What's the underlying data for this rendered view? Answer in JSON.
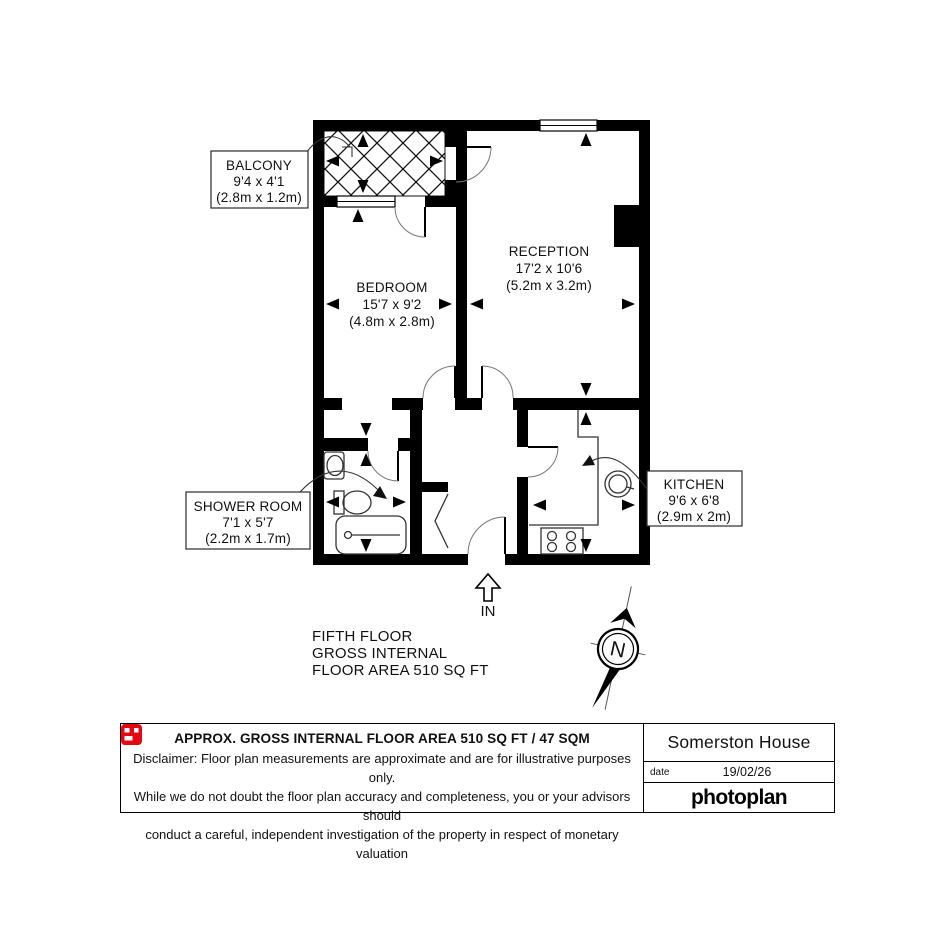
{
  "plan": {
    "rooms": {
      "balcony": {
        "name": "BALCONY",
        "imperial": "9'4 x 4'1",
        "metric": "(2.8m x 1.2m)"
      },
      "bedroom": {
        "name": "BEDROOM",
        "imperial": "15'7 x 9'2",
        "metric": "(4.8m x 2.8m)"
      },
      "reception": {
        "name": "RECEPTION",
        "imperial": "17'2 x 10'6",
        "metric": "(5.2m x 3.2m)"
      },
      "shower_room": {
        "name": "SHOWER ROOM",
        "imperial": "7'1 x 5'7",
        "metric": "(2.2m x 1.7m)"
      },
      "kitchen": {
        "name": "KITCHEN",
        "imperial": "9'6 x 6'8",
        "metric": "(2.9m x 2m)"
      }
    },
    "entrance_label": "IN",
    "compass_label": "N",
    "floor_info": {
      "line1": "FIFTH FLOOR",
      "line2": "GROSS INTERNAL",
      "line3": "FLOOR AREA 510 SQ FT"
    }
  },
  "footer": {
    "area_title": "APPROX. GROSS INTERNAL FLOOR AREA 510 SQ FT / 47 SQM",
    "disclaimer_line1": "Disclaimer: Floor plan measurements are approximate and are for illustrative purposes only.",
    "disclaimer_line2": "While we do not doubt the floor plan accuracy and completeness, you or your advisors should",
    "disclaimer_line3": "conduct a careful, independent investigation of the property in respect of monetary valuation",
    "property_name": "Somerston House",
    "date_label": "date",
    "date_value": "19/02/26",
    "brand_name": "photoplan",
    "brand_color": "#e30613"
  }
}
